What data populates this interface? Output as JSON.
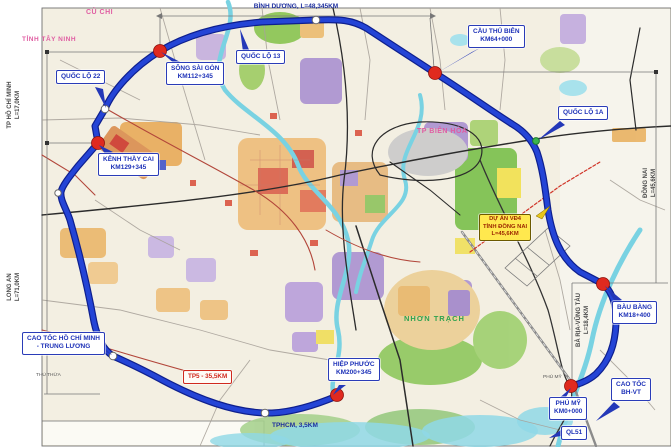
{
  "callouts": {
    "ql22": {
      "label": "QUỐC LỘ 22"
    },
    "song_sai_gon": {
      "name": "SÔNG SÀI GÒN",
      "km": "KM112+345"
    },
    "ql13": {
      "label": "QUỐC LỘ 13"
    },
    "cau_thu_bien": {
      "name": "CẦU THỦ BIÊN",
      "km": "KM64+000"
    },
    "ql1a": {
      "label": "QUỐC LỘ 1A"
    },
    "kenh_thay_cai": {
      "name": "KÊNH THẦY CAI",
      "km": "KM129+345"
    },
    "du_an_vd4": {
      "line1": "DỰ ÁN VĐ4",
      "line2": "TỈNH ĐỒNG NAI",
      "line3": "L=45,6KM"
    },
    "bau_bang": {
      "name": "BÀU BÀNG",
      "km": "KM18+400"
    },
    "cao_toc_bh_vt": {
      "line1": "CAO TỐC",
      "line2": "BH-VT"
    },
    "phu_my": {
      "name": "PHÚ MỸ",
      "km": "KM0+000"
    },
    "ql51": {
      "label": "QL51"
    },
    "hiep_phuoc": {
      "name": "HIỆP PHƯỚC",
      "km": "KM200+345"
    },
    "cao_toc_hcm_tl": {
      "line1": "CAO TỐC HỒ CHÍ MINH",
      "line2": "- TRUNG LƯƠNG"
    },
    "tp5": {
      "label": "TP5 - 35,5KM"
    }
  },
  "measurements": {
    "binh_duong": "BÌNH DƯƠNG, L=48,345KM",
    "tphcm_gap": "TPHCM, 3,5KM"
  },
  "edge_sections": {
    "tp_hcm": {
      "name": "TP HỒ CHÍ MINH",
      "length": "L=17,0KM"
    },
    "long_an": {
      "name": "LONG AN",
      "length": "L=71,0KM"
    },
    "dong_nai": {
      "name": "ĐỒNG NAI",
      "length": "L=45,6KM"
    },
    "ba_ria_vung_tau": {
      "name": "BÀ RỊA-VŨNG TÀU",
      "length": "L=18,4KM"
    }
  },
  "map_labels": {
    "cu_chi": "CỦ CHI",
    "tinh_tay_ninh": "TỈNH TÂY NINH",
    "tp_bien_hoa": "TP BIÊN HÒA",
    "nhon_trach": "NHƠN TRẠCH",
    "phu_my_town": "PHÚ MỸ",
    "thu_thua": "THỦ THỪA"
  },
  "colors": {
    "ring_road_blue": "#2444d6",
    "callout_blue": "#1e32b8",
    "junction_red": "#e02a1f",
    "project_yellow": "#ffe84e",
    "region_pink": "#e05da2"
  }
}
